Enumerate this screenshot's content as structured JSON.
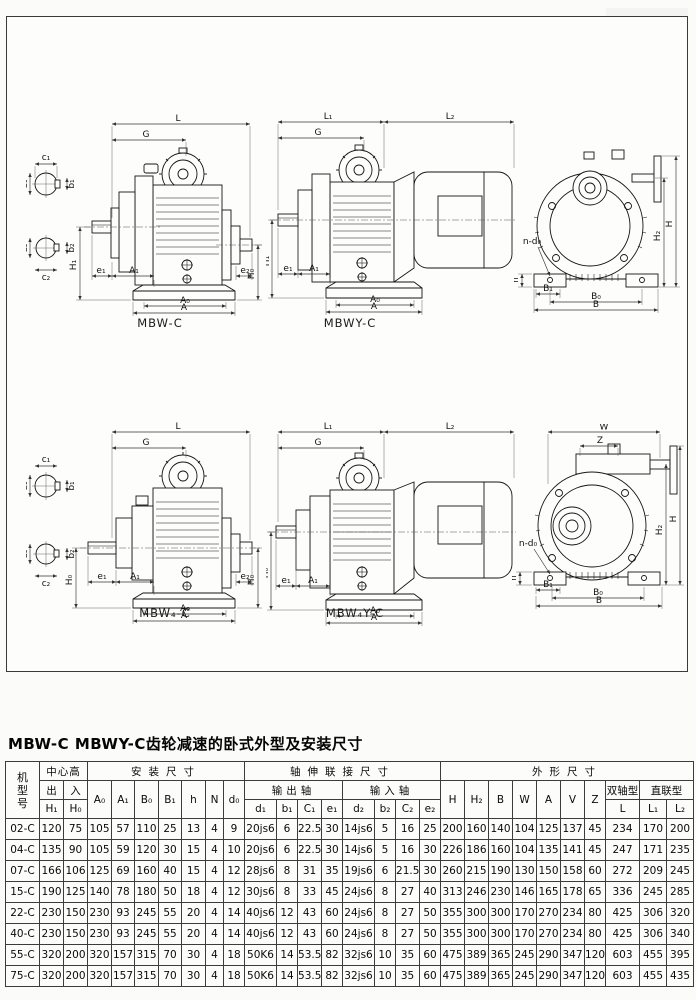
{
  "page": {
    "title": "MBW-C MBWY-C齿轮减速的卧式外型及安装尺寸"
  },
  "photo": {
    "icon": "gear-motor-photo"
  },
  "captions": {
    "top_left": "MBW-C",
    "top_middle": "MBWY-C",
    "bottom_left": "MBW₄-C",
    "bottom_middle": "MBW₄Y-C"
  },
  "dim_labels": {
    "L": "L",
    "L1": "L₁",
    "L2": "L₂",
    "G": "G",
    "H": "H",
    "H0": "H₀",
    "H1": "H₁",
    "H2": "H₂",
    "A": "A",
    "A0": "A₀",
    "A1": "A₁",
    "B": "B",
    "B0": "B₀",
    "B1": "B₁",
    "W": "W",
    "Z": "Z",
    "h": "h",
    "n_d0": "n-d₀",
    "e1": "e₁",
    "e2": "e₂",
    "c1": "c₁",
    "c2": "c₂",
    "b1": "b₁",
    "b2": "b₂",
    "d1": "d₁",
    "d2": "d₂"
  },
  "table": {
    "headers": {
      "model_chars": [
        "机",
        "型",
        "号"
      ],
      "center_height": "中心高",
      "out": "出",
      "in": "入",
      "h1": "H₁",
      "h0": "H₀",
      "install": "安装尺寸",
      "install_cols": [
        "A₀",
        "A₁",
        "B₀",
        "B₁",
        "h",
        "N",
        "d₀"
      ],
      "shaft": "轴伸联接尺寸",
      "output_shaft": "输出轴",
      "input_shaft": "输入轴",
      "output_cols": [
        "d₁",
        "b₁",
        "C₁",
        "e₁"
      ],
      "input_cols": [
        "d₂",
        "b₂",
        "C₂",
        "e₂"
      ],
      "outline": "外形尺寸",
      "outline_cols": [
        "H",
        "H₂",
        "B",
        "W",
        "A",
        "V",
        "Z"
      ],
      "dual_shaft": "双轴型",
      "direct": "直联型",
      "L": "L",
      "L1": "L₁",
      "L2": "L₂"
    },
    "rows": [
      {
        "model": "02-C",
        "values": [
          "120",
          "75",
          "105",
          "57",
          "110",
          "25",
          "13",
          "4",
          "9",
          "20js6",
          "6",
          "22.5",
          "30",
          "14js6",
          "5",
          "16",
          "25",
          "200",
          "160",
          "140",
          "104",
          "125",
          "137",
          "45",
          "234",
          "170",
          "200"
        ]
      },
      {
        "model": "04-C",
        "values": [
          "135",
          "90",
          "105",
          "59",
          "120",
          "30",
          "15",
          "4",
          "10",
          "20js6",
          "6",
          "22.5",
          "30",
          "14js6",
          "5",
          "16",
          "30",
          "226",
          "186",
          "160",
          "104",
          "135",
          "141",
          "45",
          "247",
          "171",
          "235"
        ]
      },
      {
        "model": "07-C",
        "values": [
          "166",
          "106",
          "125",
          "69",
          "160",
          "40",
          "15",
          "4",
          "12",
          "28js6",
          "8",
          "31",
          "35",
          "19js6",
          "6",
          "21.5",
          "30",
          "260",
          "215",
          "190",
          "130",
          "150",
          "158",
          "60",
          "272",
          "209",
          "245"
        ]
      },
      {
        "model": "15-C",
        "values": [
          "190",
          "125",
          "140",
          "78",
          "180",
          "50",
          "18",
          "4",
          "12",
          "30js6",
          "8",
          "33",
          "45",
          "24js6",
          "8",
          "27",
          "40",
          "313",
          "246",
          "230",
          "146",
          "165",
          "178",
          "65",
          "336",
          "245",
          "285"
        ]
      },
      {
        "model": "22-C",
        "values": [
          "230",
          "150",
          "230",
          "93",
          "245",
          "55",
          "20",
          "4",
          "14",
          "40js6",
          "12",
          "43",
          "60",
          "24js6",
          "8",
          "27",
          "50",
          "355",
          "300",
          "300",
          "170",
          "270",
          "234",
          "80",
          "425",
          "306",
          "320"
        ]
      },
      {
        "model": "40-C",
        "values": [
          "230",
          "150",
          "230",
          "93",
          "245",
          "55",
          "20",
          "4",
          "14",
          "40js6",
          "12",
          "43",
          "60",
          "24js6",
          "8",
          "27",
          "50",
          "355",
          "300",
          "300",
          "170",
          "270",
          "234",
          "80",
          "425",
          "306",
          "340"
        ]
      },
      {
        "model": "55-C",
        "values": [
          "320",
          "200",
          "320",
          "157",
          "315",
          "70",
          "30",
          "4",
          "18",
          "50K6",
          "14",
          "53.5",
          "82",
          "32js6",
          "10",
          "35",
          "60",
          "475",
          "389",
          "365",
          "245",
          "290",
          "347",
          "120",
          "603",
          "455",
          "395"
        ]
      },
      {
        "model": "75-C",
        "values": [
          "320",
          "200",
          "320",
          "157",
          "315",
          "70",
          "30",
          "4",
          "18",
          "50K6",
          "14",
          "53.5",
          "82",
          "32js6",
          "10",
          "35",
          "60",
          "475",
          "389",
          "365",
          "245",
          "290",
          "347",
          "120",
          "603",
          "455",
          "435"
        ]
      }
    ]
  }
}
